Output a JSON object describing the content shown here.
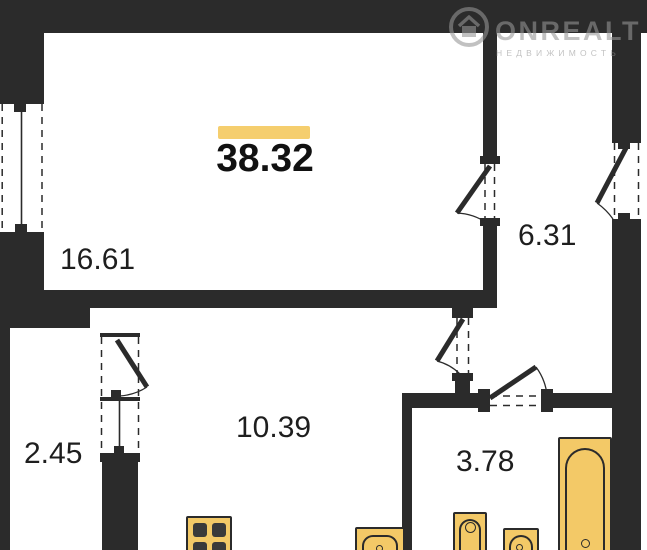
{
  "brand": {
    "name": "ONREALT",
    "tagline": "НЕДВИЖИМОСТЬ",
    "icon": "house-in-circle-icon"
  },
  "plan": {
    "total_area": "38.32",
    "rooms": [
      {
        "id": "living-room",
        "area": "16.61"
      },
      {
        "id": "hallway",
        "area": "6.31"
      },
      {
        "id": "kitchen-living",
        "area": "10.39"
      },
      {
        "id": "balcony",
        "area": "2.45"
      },
      {
        "id": "bathroom",
        "area": "3.78"
      }
    ],
    "fixtures": [
      {
        "icon": "stove-icon"
      },
      {
        "icon": "kitchen-sink-icon"
      },
      {
        "icon": "washbasin-icon"
      },
      {
        "icon": "toilet-icon"
      },
      {
        "icon": "bathtub-icon"
      }
    ]
  },
  "colors": {
    "wall": "#2b2b2b",
    "background": "#ffffff",
    "accent": "#f5ce6e",
    "fixture": "#f3c967",
    "burner": "#3a3a3a",
    "watermark": "#969696"
  }
}
